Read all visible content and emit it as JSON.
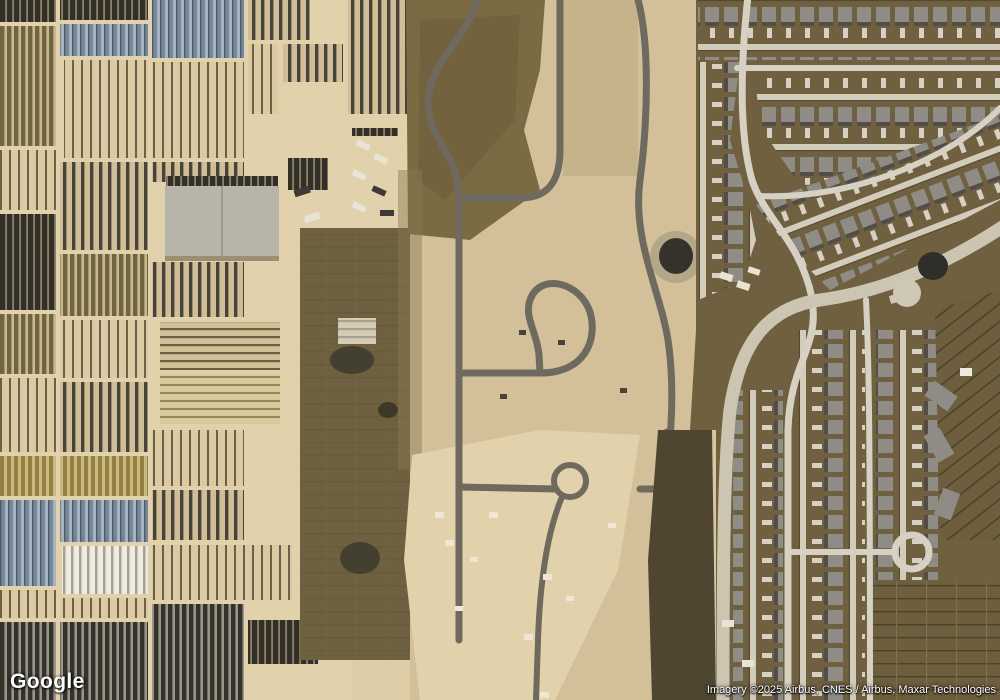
{
  "map": {
    "provider_logo": "Google",
    "attribution": "Imagery ©2025 Airbus, CNES / Airbus, Maxar Technologies",
    "view_type": "satellite-imagery",
    "scene": {
      "left_region": "plant-nursery-fields-and-greenhouses",
      "center_region": "graded-construction-site-with-new-roads",
      "right_region": "suburban-residential-subdivision"
    },
    "colors": {
      "dirt_tan": "#d8c69e",
      "dirt_pale": "#e3d3ad",
      "construction_road_gray": "#6e6a5e",
      "residential_ground_olive": "#6f6140",
      "street_light": "#d6d1c2",
      "roof_gray": "#8f8c86",
      "greenhouse_blue": "#74889c",
      "hoop_house_white": "#eceae2",
      "plot_dark": "#312f27",
      "warehouse_gray": "#b7b4aa",
      "pond_dark": "#34322a",
      "attribution_text": "#ffffff"
    }
  }
}
